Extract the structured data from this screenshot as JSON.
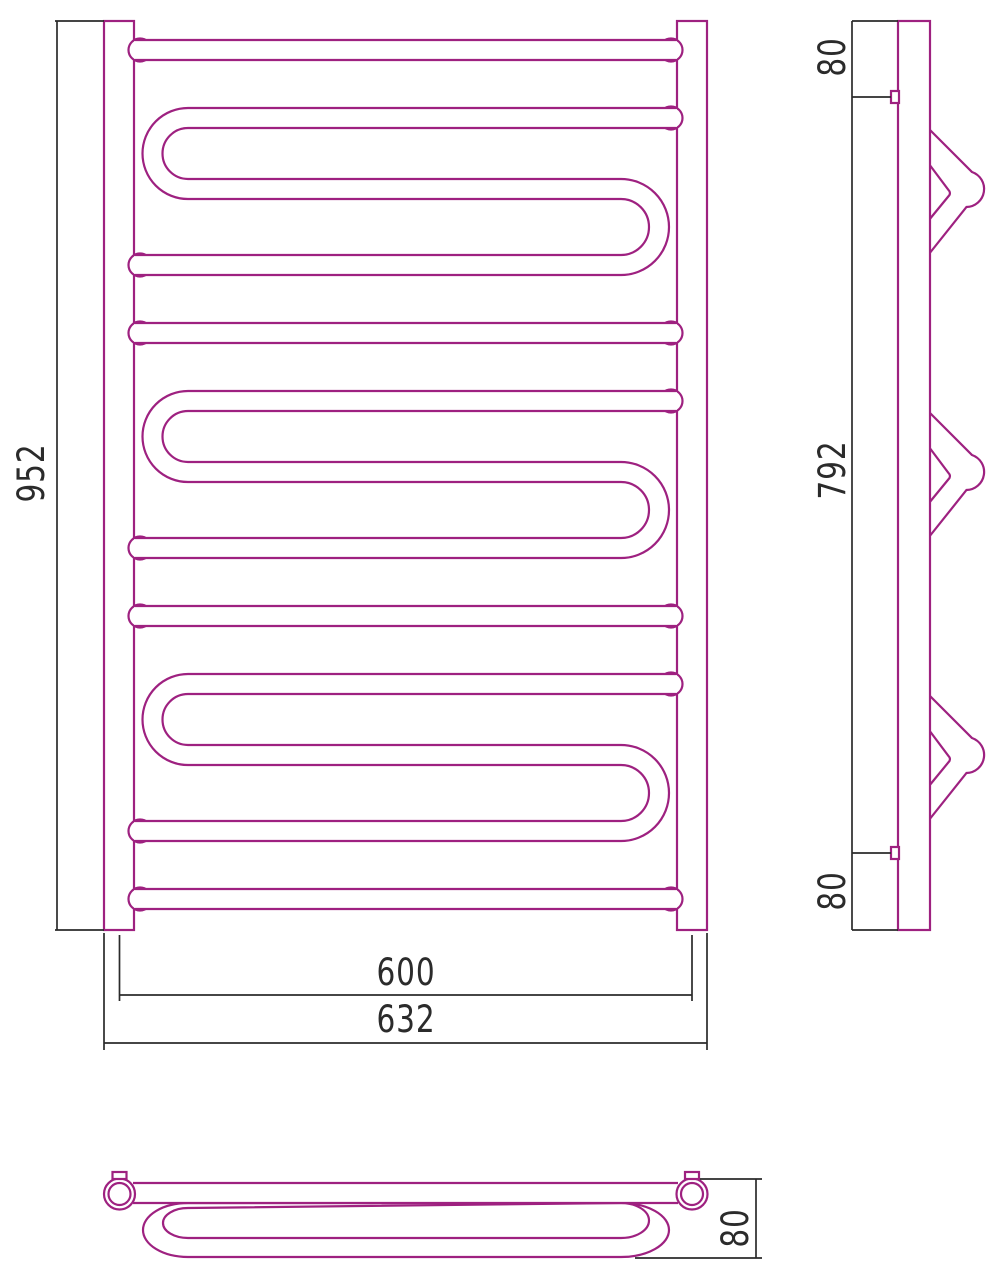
{
  "drawing_title": "towel-radiator-three-view-technical-drawing",
  "colors": {
    "outline": "#9e2180",
    "dimension": "#2b2b2b",
    "background": "#ffffff"
  },
  "front_view": {
    "height_mm": "952",
    "rail_width_mm": "600",
    "overall_width_mm": "632"
  },
  "side_view": {
    "top_offset_mm": "80",
    "mount_span_mm": "792",
    "bottom_offset_mm": "80"
  },
  "top_view": {
    "depth_mm": "80"
  }
}
